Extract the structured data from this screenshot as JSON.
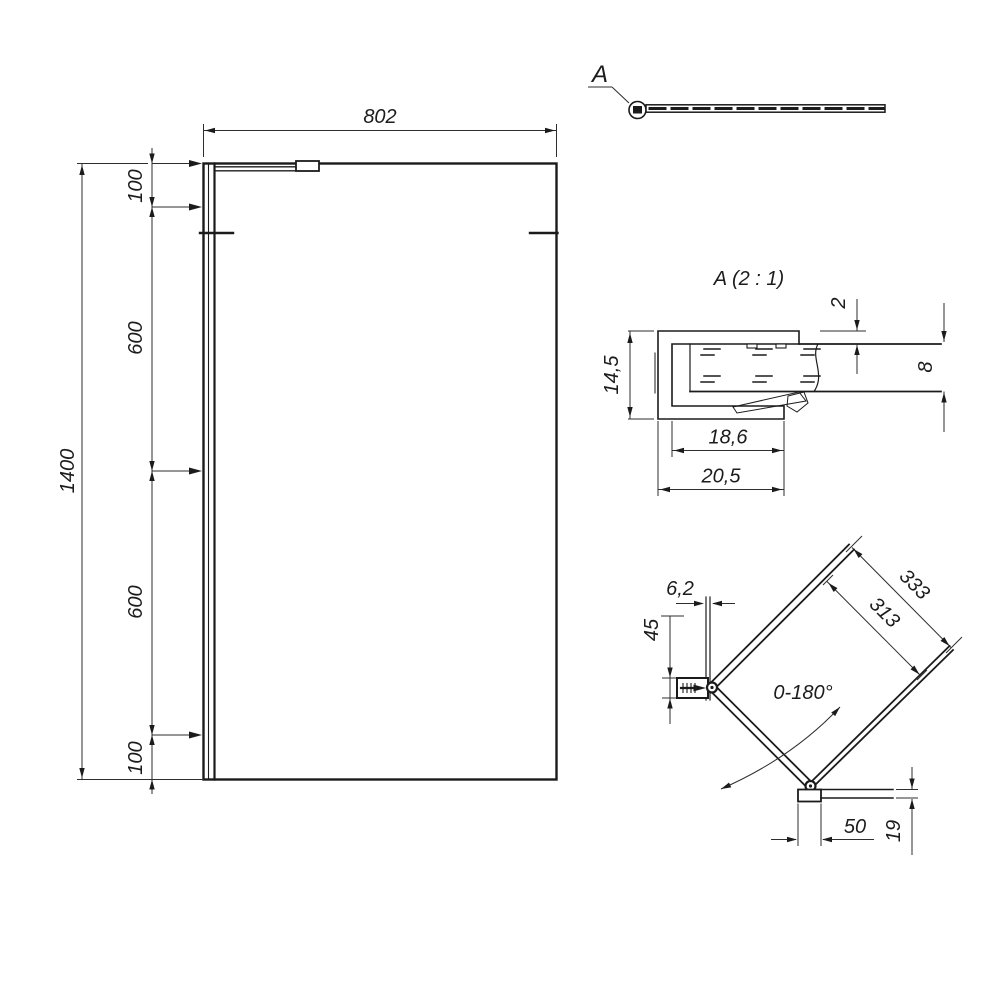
{
  "drawing": {
    "front_view": {
      "width": "802",
      "height": "1400",
      "segments": [
        "100",
        "600",
        "600",
        "100"
      ]
    },
    "top_view": {
      "callout_label": "A"
    },
    "detail_a": {
      "title": "A (2 : 1)",
      "flange_thickness": "2",
      "profile_height": "14,5",
      "glass_thickness": "8",
      "inner_depth": "18,6",
      "outer_depth": "20,5"
    },
    "support_arm": {
      "glass_thickness": "6,2",
      "bracket_height": "45",
      "outer_length": "333",
      "inner_length": "313",
      "swivel_range": "0-180°",
      "bracket_width": "50",
      "bar_width": "19"
    }
  },
  "colors": {
    "object_line": "#1b1b1b",
    "dimension_line": "#2e2e2e",
    "background": "#ffffff"
  }
}
